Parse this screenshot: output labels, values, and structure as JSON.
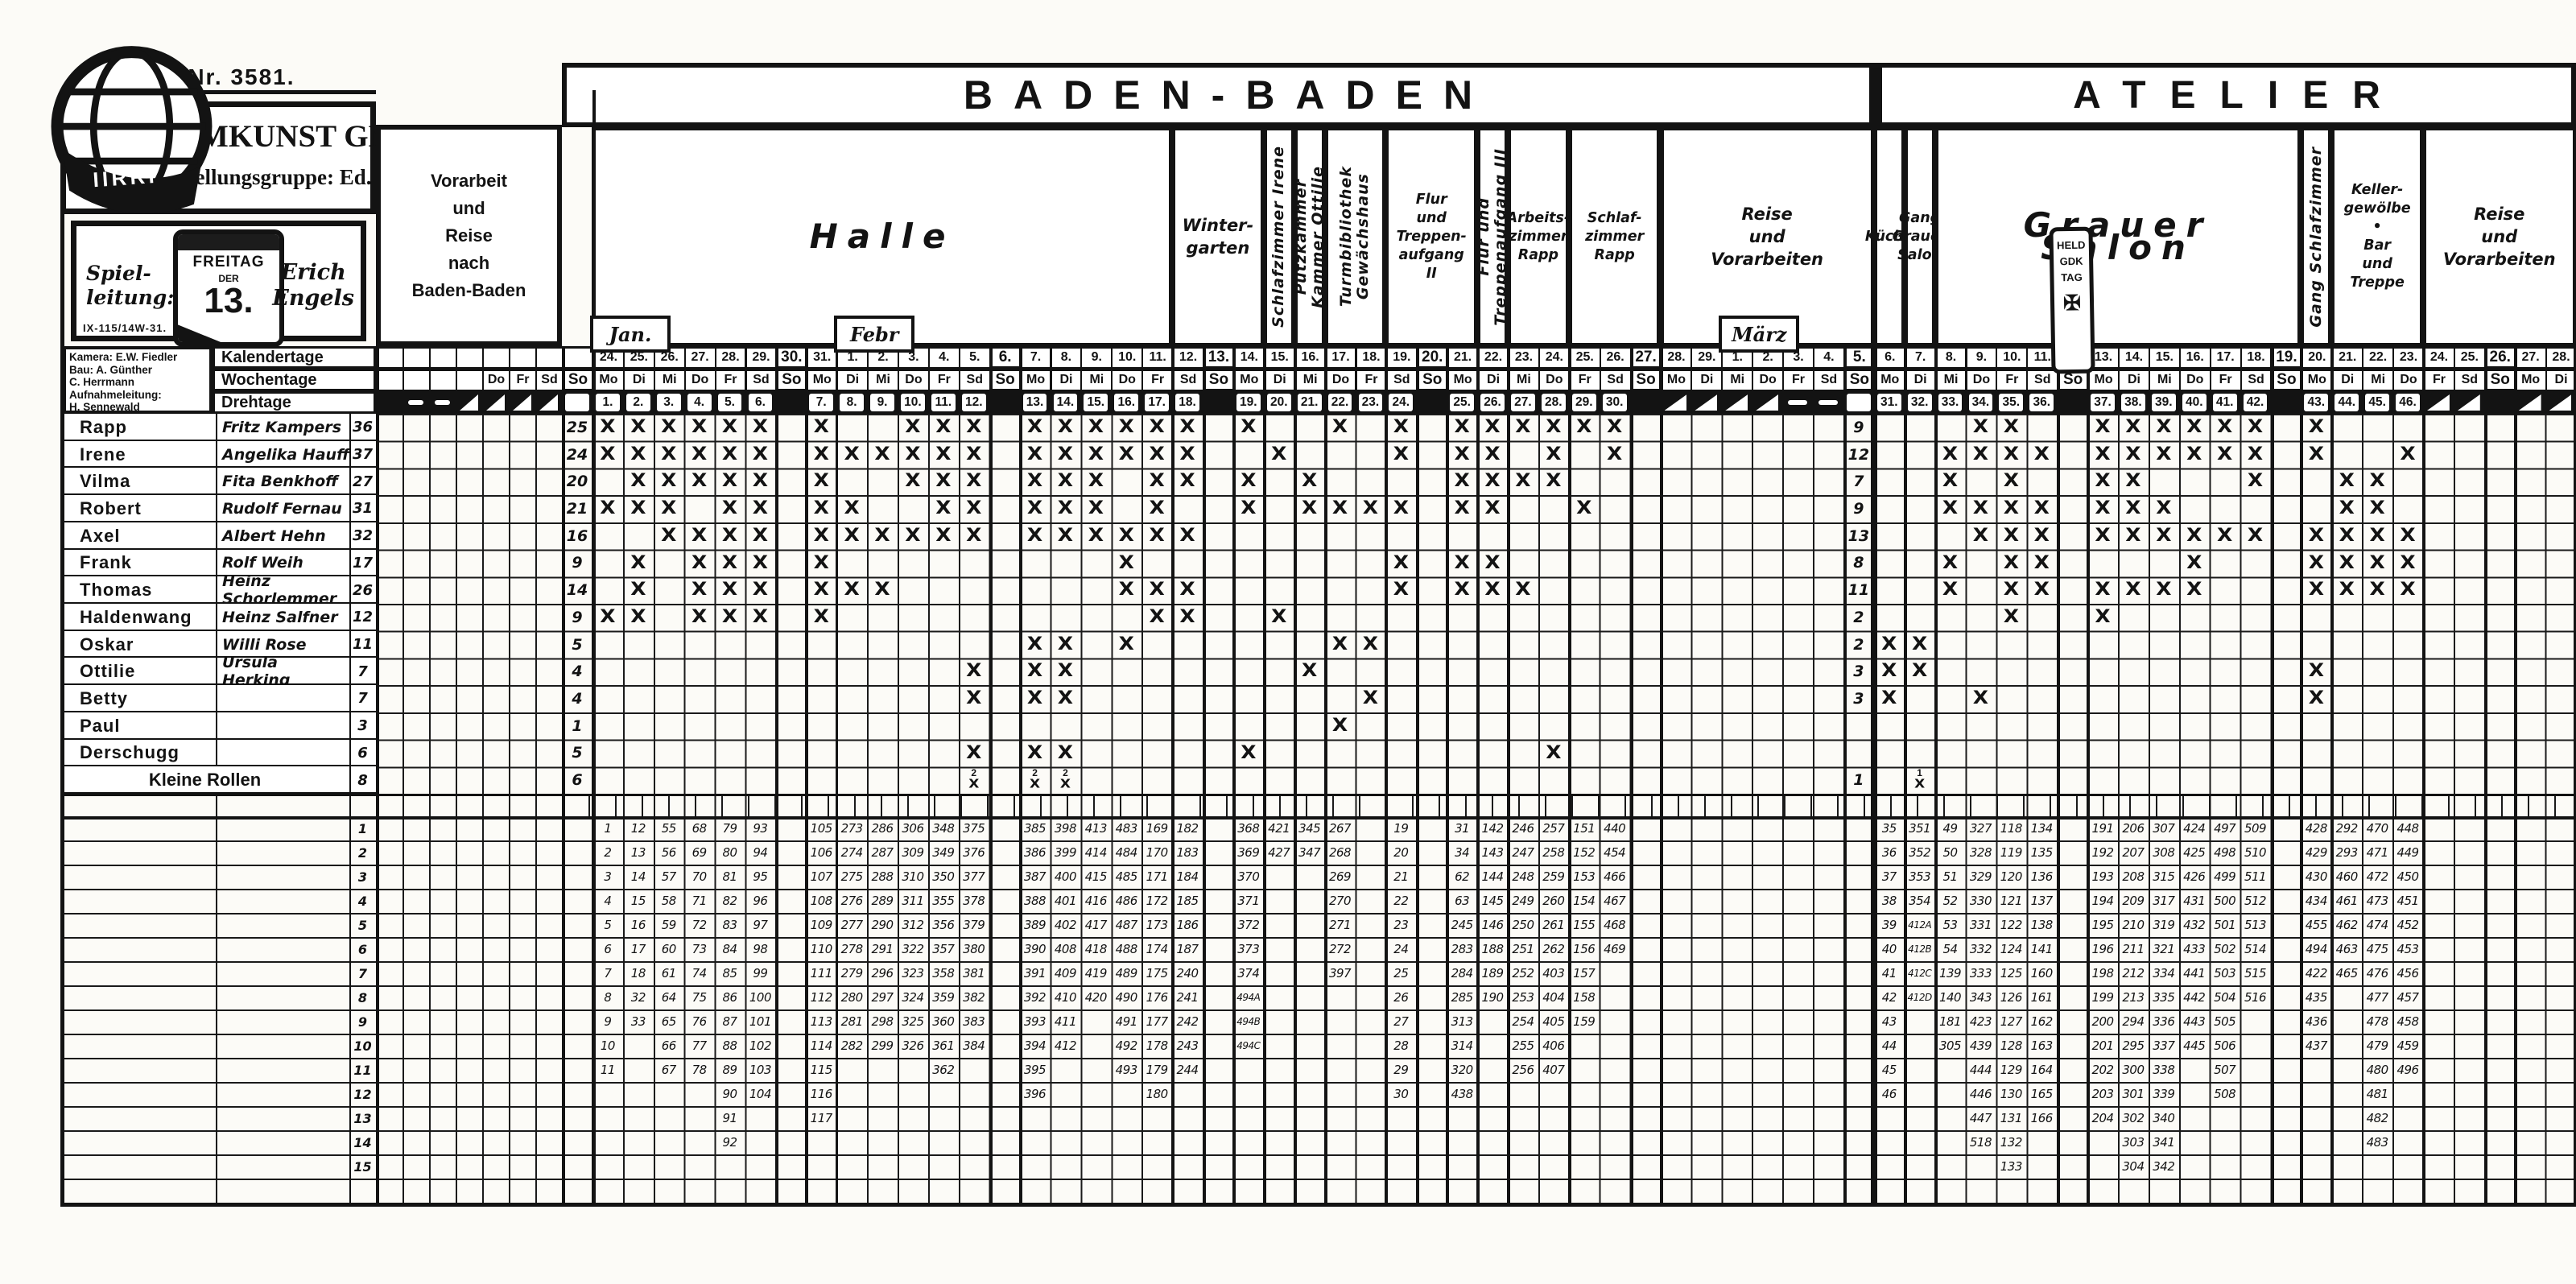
{
  "page": {
    "film_nr": "Film Nr. 3581.",
    "company": "FILMKUNST GMBH.",
    "company_group": "Herstellungsgruppe: Ed. Kubat",
    "spielleitung": [
      "Spiel-",
      "leitung:"
    ],
    "director": [
      "Erich",
      "Engels"
    ],
    "prod_code": "IX-115/14W-31.",
    "stamp": [
      "FREITAG",
      "DER",
      "13."
    ],
    "crew": [
      "Kamera: E.W. Fiedler",
      "Bau: A. Günther",
      "    C. Herrmann",
      "Aufnahmeleitung:",
      "    H. Sennewald"
    ],
    "logo_icon": "terra-globe-logo"
  },
  "sections": {
    "baden": "BADEN-BADEN",
    "atelier": "ATELIER",
    "vorarbeit": [
      "Vorarbeit",
      "und",
      "Reise",
      "nach",
      "Baden-Baden"
    ]
  },
  "row_labels": [
    "Kalendertage",
    "Wochentage",
    "Drehtage"
  ],
  "month_tabs": [
    {
      "label": "Jan.",
      "col": 0
    },
    {
      "label": "Febr",
      "col": 8
    },
    {
      "label": "März",
      "col": 37
    }
  ],
  "held_stamp": {
    "lines": [
      "HELD",
      "GDK",
      "TAG"
    ],
    "cross": "✠",
    "col": 48
  },
  "prep": {
    "wd": [
      "",
      "",
      "",
      "",
      "Do",
      "Fr",
      "Sd"
    ],
    "dt": [
      "bk",
      "d",
      "d",
      "h",
      "h",
      "h",
      "h"
    ]
  },
  "so_col": {
    "wd": "So"
  },
  "groups": {
    "baden": [
      {
        "l": [
          "Halle"
        ],
        "c": [
          0,
          18
        ],
        "big": 1
      },
      {
        "l": [
          "Winter-",
          "garten"
        ],
        "c": [
          19,
          21
        ]
      },
      {
        "l": [
          "Schlafzimmer Irene"
        ],
        "c": [
          22,
          22
        ],
        "vert": 1
      },
      {
        "l": [
          "Putzkammer",
          "Kammer Ottilie"
        ],
        "c": [
          23,
          23
        ],
        "vert": 1
      },
      {
        "l": [
          "Turmbibliothek",
          "Gewächshaus"
        ],
        "c": [
          24,
          25
        ],
        "vert": 1
      },
      {
        "l": [
          "Flur",
          "und",
          "Treppen-",
          "aufgang",
          "II"
        ],
        "c": [
          26,
          28
        ],
        "small": 1
      },
      {
        "l": [
          "Flur und",
          "Treppenaufgang III"
        ],
        "c": [
          29,
          29
        ],
        "vert": 1
      },
      {
        "l": [
          "Arbeits-",
          "zimmer",
          "Rapp"
        ],
        "c": [
          30,
          31
        ],
        "small": 1
      },
      {
        "l": [
          "Schlaf-",
          "zimmer",
          "Rapp"
        ],
        "c": [
          32,
          34
        ],
        "small": 1
      },
      {
        "l": [
          "Reise",
          "und",
          "Vorarbeiten"
        ],
        "c": [
          35,
          41
        ]
      }
    ],
    "atelier": [
      {
        "l": [
          "Küche"
        ],
        "c": [
          42,
          42
        ],
        "small": 1
      },
      {
        "l": [
          "Gang",
          "Grauer",
          "Salon"
        ],
        "c": [
          43,
          43
        ],
        "small": 1
      },
      {
        "l": [
          "Grauer Salon"
        ],
        "c": [
          44,
          55
        ],
        "big": 1
      },
      {
        "l": [
          "Gang Schlafzimmer"
        ],
        "c": [
          56,
          56
        ],
        "vert": 1
      },
      {
        "l": [
          "Keller-",
          "gewölbe",
          "•",
          "Bar",
          "und",
          "Treppe"
        ],
        "c": [
          57,
          59
        ],
        "small": 1
      },
      {
        "l": [
          "Reise",
          "und",
          "Vorarbeiten"
        ],
        "c": [
          60,
          64
        ]
      }
    ]
  },
  "columns": [
    [
      "24.",
      "Mo",
      "1",
      ""
    ],
    [
      "25.",
      "Di",
      "2",
      ""
    ],
    [
      "26.",
      "Mi",
      "3",
      ""
    ],
    [
      "27.",
      "Do",
      "4",
      ""
    ],
    [
      "28.",
      "Fr",
      "5",
      ""
    ],
    [
      "29.",
      "Sd",
      "6",
      ""
    ],
    [
      "30.",
      "So",
      "",
      "su"
    ],
    [
      "31.",
      "Mo",
      "7",
      ""
    ],
    [
      "1.",
      "Di",
      "8",
      ""
    ],
    [
      "2.",
      "Mi",
      "9",
      ""
    ],
    [
      "3.",
      "Do",
      "10",
      ""
    ],
    [
      "4.",
      "Fr",
      "11",
      ""
    ],
    [
      "5.",
      "Sd",
      "12",
      ""
    ],
    [
      "6.",
      "So",
      "",
      "su"
    ],
    [
      "7.",
      "Mo",
      "13",
      ""
    ],
    [
      "8.",
      "Di",
      "14",
      ""
    ],
    [
      "9.",
      "Mi",
      "15",
      ""
    ],
    [
      "10.",
      "Do",
      "16",
      ""
    ],
    [
      "11.",
      "Fr",
      "17",
      ""
    ],
    [
      "12.",
      "Sd",
      "18",
      ""
    ],
    [
      "13.",
      "So",
      "",
      "su"
    ],
    [
      "14.",
      "Mo",
      "19",
      ""
    ],
    [
      "15.",
      "Di",
      "20",
      ""
    ],
    [
      "16.",
      "Mi",
      "21",
      ""
    ],
    [
      "17.",
      "Do",
      "22",
      ""
    ],
    [
      "18.",
      "Fr",
      "23",
      ""
    ],
    [
      "19.",
      "Sd",
      "24",
      ""
    ],
    [
      "20.",
      "So",
      "",
      "su"
    ],
    [
      "21.",
      "Mo",
      "25",
      ""
    ],
    [
      "22.",
      "Di",
      "26",
      ""
    ],
    [
      "23.",
      "Mi",
      "27",
      ""
    ],
    [
      "24.",
      "Do",
      "28",
      ""
    ],
    [
      "25.",
      "Fr",
      "29",
      ""
    ],
    [
      "26.",
      "Sd",
      "30",
      ""
    ],
    [
      "27.",
      "So",
      "",
      "su"
    ],
    [
      "28.",
      "Mo",
      "",
      "h"
    ],
    [
      "29.",
      "Di",
      "",
      "h"
    ],
    [
      "1.",
      "Mi",
      "",
      "h"
    ],
    [
      "2.",
      "Do",
      "",
      "h"
    ],
    [
      "3.",
      "Fr",
      "",
      "d"
    ],
    [
      "4.",
      "Sd",
      "",
      "d"
    ],
    [
      "5.",
      "So",
      "",
      "ct"
    ],
    [
      "6.",
      "Mo",
      "31",
      ""
    ],
    [
      "7.",
      "Di",
      "32",
      ""
    ],
    [
      "8.",
      "Mi",
      "33",
      ""
    ],
    [
      "9.",
      "Do",
      "34",
      ""
    ],
    [
      "10.",
      "Fr",
      "35",
      ""
    ],
    [
      "11.",
      "Sd",
      "36",
      ""
    ],
    [
      "12.",
      "So",
      "",
      "bk"
    ],
    [
      "13.",
      "Mo",
      "37",
      ""
    ],
    [
      "14.",
      "Di",
      "38",
      ""
    ],
    [
      "15.",
      "Mi",
      "39",
      ""
    ],
    [
      "16.",
      "Do",
      "40",
      ""
    ],
    [
      "17.",
      "Fr",
      "41",
      ""
    ],
    [
      "18.",
      "Sd",
      "42",
      ""
    ],
    [
      "19.",
      "So",
      "",
      "su"
    ],
    [
      "20.",
      "Mo",
      "43",
      ""
    ],
    [
      "21.",
      "Di",
      "44",
      ""
    ],
    [
      "22.",
      "Mi",
      "45",
      ""
    ],
    [
      "23.",
      "Do",
      "46",
      ""
    ],
    [
      "24.",
      "Fr",
      "",
      "h"
    ],
    [
      "25.",
      "Sd",
      "",
      "h"
    ],
    [
      "26.",
      "So",
      "",
      "su"
    ],
    [
      "27.",
      "Mo",
      "",
      "h"
    ],
    [
      "28.",
      "Di",
      "",
      "h"
    ]
  ],
  "cast": [
    {
      "role": "Rapp",
      "actor": "Fritz Kampers",
      "total": "36",
      "bb": "25",
      "at": "9",
      "x": [
        1,
        2,
        3,
        4,
        5,
        6,
        7,
        10,
        11,
        12,
        13,
        14,
        15,
        16,
        17,
        18,
        19,
        22,
        24,
        25,
        26,
        27,
        28,
        29,
        30,
        34,
        35,
        37,
        38,
        39,
        40,
        41,
        42,
        43
      ]
    },
    {
      "role": "Irene",
      "actor": "Angelika Hauff",
      "total": "37",
      "bb": "24",
      "at": "12",
      "x": [
        1,
        2,
        3,
        4,
        5,
        6,
        7,
        8,
        9,
        10,
        11,
        12,
        13,
        14,
        15,
        16,
        17,
        18,
        20,
        24,
        25,
        26,
        28,
        30,
        33,
        34,
        35,
        36,
        37,
        38,
        39,
        40,
        41,
        42,
        43,
        46
      ]
    },
    {
      "role": "Vilma",
      "actor": "Fita Benkhoff",
      "total": "27",
      "bb": "20",
      "at": "7",
      "x": [
        2,
        3,
        4,
        5,
        6,
        7,
        10,
        11,
        12,
        13,
        14,
        15,
        17,
        18,
        19,
        21,
        25,
        26,
        27,
        28,
        33,
        35,
        37,
        38,
        42,
        44,
        45
      ]
    },
    {
      "role": "Robert",
      "actor": "Rudolf Fernau",
      "total": "31",
      "bb": "21",
      "at": "9",
      "x": [
        1,
        2,
        3,
        5,
        6,
        7,
        8,
        11,
        12,
        13,
        14,
        15,
        17,
        19,
        21,
        22,
        23,
        24,
        25,
        26,
        29,
        33,
        34,
        35,
        36,
        37,
        38,
        39,
        44,
        45
      ]
    },
    {
      "role": "Axel",
      "actor": "Albert Hehn",
      "total": "32",
      "bb": "16",
      "at": "13",
      "x": [
        3,
        4,
        5,
        6,
        7,
        8,
        9,
        10,
        11,
        12,
        13,
        14,
        15,
        16,
        17,
        18,
        34,
        35,
        36,
        37,
        38,
        39,
        40,
        41,
        42,
        43,
        44,
        45,
        46
      ]
    },
    {
      "role": "Frank",
      "actor": "Rolf Weih",
      "total": "17",
      "bb": "9",
      "at": "8",
      "x": [
        2,
        4,
        5,
        6,
        7,
        16,
        24,
        25,
        26,
        33,
        35,
        36,
        40,
        43,
        44,
        45,
        46
      ]
    },
    {
      "role": "Thomas",
      "actor": "Heinz Schorlemmer",
      "total": "26",
      "bb": "14",
      "at": "11",
      "x": [
        2,
        4,
        5,
        6,
        7,
        8,
        9,
        16,
        17,
        18,
        24,
        25,
        26,
        27,
        33,
        35,
        36,
        37,
        38,
        39,
        40,
        43,
        44,
        45,
        46
      ]
    },
    {
      "role": "Haldenwang",
      "actor": "Heinz Salfner",
      "total": "12",
      "bb": "9",
      "at": "2",
      "x": [
        1,
        2,
        4,
        5,
        6,
        7,
        17,
        18,
        20,
        35,
        37
      ]
    },
    {
      "role": "Oskar",
      "actor": "Willi Rose",
      "total": "11",
      "bb": "5",
      "at": "2",
      "x": [
        13,
        14,
        16,
        22,
        23,
        31,
        32
      ]
    },
    {
      "role": "Ottilie",
      "actor": "Ursula Herking",
      "total": "7",
      "bb": "4",
      "at": "3",
      "x": [
        12,
        13,
        14,
        21,
        31,
        32,
        43
      ]
    },
    {
      "role": "Betty",
      "actor": "",
      "total": "7",
      "bb": "4",
      "at": "3",
      "x": [
        12,
        13,
        14,
        23,
        31,
        34,
        43
      ]
    },
    {
      "role": "Paul",
      "actor": "",
      "total": "3",
      "bb": "1",
      "at": "",
      "x": [
        22
      ]
    },
    {
      "role": "Derschugg",
      "actor": "",
      "total": "6",
      "bb": "5",
      "at": "",
      "x": [
        12,
        13,
        14,
        19,
        28
      ]
    },
    {
      "role": "Kleine Rollen",
      "actor": "",
      "total": "8",
      "bb": "6",
      "at": "1",
      "span": 1,
      "x": [],
      "xn": [
        [
          12,
          "2"
        ],
        [
          13,
          "2"
        ],
        [
          14,
          "2"
        ],
        [
          32,
          "1"
        ]
      ]
    }
  ],
  "bottom_rows": [
    "1",
    "2",
    "3",
    "4",
    "5",
    "6",
    "7",
    "8",
    "9",
    "10",
    "11",
    "12",
    "13",
    "14",
    "15",
    ""
  ],
  "scenes": {
    "1": [
      "1",
      "2",
      "3",
      "4",
      "5",
      "6",
      "7",
      "8",
      "9",
      "10",
      "11"
    ],
    "2": [
      "12",
      "13",
      "14",
      "15",
      "16",
      "17",
      "18",
      "32",
      "33"
    ],
    "3": [
      "55",
      "56",
      "57",
      "58",
      "59",
      "60",
      "61",
      "64",
      "65",
      "66",
      "67"
    ],
    "4": [
      "68",
      "69",
      "70",
      "71",
      "72",
      "73",
      "74",
      "75",
      "76",
      "77",
      "78"
    ],
    "5": [
      "79",
      "80",
      "81",
      "82",
      "83",
      "84",
      "85",
      "86",
      "87",
      "88",
      "89",
      "90",
      "91",
      "92"
    ],
    "6": [
      "93",
      "94",
      "95",
      "96",
      "97",
      "98",
      "99",
      "100",
      "101",
      "102",
      "103",
      "104"
    ],
    "7": [
      "105",
      "106",
      "107",
      "108",
      "109",
      "110",
      "111",
      "112",
      "113",
      "114",
      "115",
      "116",
      "117"
    ],
    "8": [
      "273",
      "274",
      "275",
      "276",
      "277",
      "278",
      "279",
      "280",
      "281",
      "282"
    ],
    "9": [
      "286",
      "287",
      "288",
      "289",
      "290",
      "291",
      "296",
      "297",
      "298",
      "299"
    ],
    "10": [
      "306",
      "309",
      "310",
      "311",
      "312",
      "322",
      "323",
      "324",
      "325",
      "326"
    ],
    "11": [
      "348",
      "349",
      "350",
      "355",
      "356",
      "357",
      "358",
      "359",
      "360",
      "361",
      "362"
    ],
    "12": [
      "375",
      "376",
      "377",
      "378",
      "379",
      "380",
      "381",
      "382",
      "383",
      "384"
    ],
    "13": [
      "385",
      "386",
      "387",
      "388",
      "389",
      "390",
      "391",
      "392",
      "393",
      "394",
      "395",
      "396"
    ],
    "14": [
      "398",
      "399",
      "400",
      "401",
      "402",
      "408",
      "409",
      "410",
      "411",
      "412"
    ],
    "15": [
      "413",
      "414",
      "415",
      "416",
      "417",
      "418",
      "419",
      "420"
    ],
    "16": [
      "483",
      "484",
      "485",
      "486",
      "487",
      "488",
      "489",
      "490",
      "491",
      "492",
      "493"
    ],
    "17": [
      "169",
      "170",
      "171",
      "172",
      "173",
      "174",
      "175",
      "176",
      "177",
      "178",
      "179",
      "180"
    ],
    "18": [
      "182",
      "183",
      "184",
      "185",
      "186",
      "187",
      "240",
      "241",
      "242",
      "243",
      "244"
    ],
    "19": [
      "368",
      "369",
      "370",
      "371",
      "372",
      "373",
      "374",
      "494A",
      "494B",
      "494C"
    ],
    "20": [
      "421",
      "427"
    ],
    "21": [
      "345",
      "347"
    ],
    "22": [
      "267",
      "268",
      "269",
      "270",
      "271",
      "272",
      "397"
    ],
    "24": [
      "19",
      "20",
      "21",
      "22",
      "23",
      "24",
      "25",
      "26",
      "27",
      "28",
      "29",
      "30"
    ],
    "25": [
      "31",
      "34",
      "62",
      "63",
      "245",
      "283",
      "284",
      "285",
      "313",
      "314",
      "320",
      "438"
    ],
    "26": [
      "142",
      "143",
      "144",
      "145",
      "146",
      "188",
      "189",
      "190"
    ],
    "27": [
      "246",
      "247",
      "248",
      "249",
      "250",
      "251",
      "252",
      "253",
      "254",
      "255",
      "256"
    ],
    "28": [
      "257",
      "258",
      "259",
      "260",
      "261",
      "262",
      "403",
      "404",
      "405",
      "406",
      "407"
    ],
    "29": [
      "151",
      "152",
      "153",
      "154",
      "155",
      "156",
      "157",
      "158",
      "159"
    ],
    "30": [
      "440",
      "454",
      "466",
      "467",
      "468",
      "469"
    ],
    "31": [
      "35",
      "36",
      "37",
      "38",
      "39",
      "40",
      "41",
      "42",
      "43",
      "44",
      "45",
      "46"
    ],
    "32": [
      "351",
      "352",
      "353",
      "354",
      "412A",
      "412B",
      "412C",
      "412D"
    ],
    "33": [
      "49",
      "50",
      "51",
      "52",
      "53",
      "54",
      "139",
      "140",
      "181",
      "305"
    ],
    "34": [
      "327",
      "328",
      "329",
      "330",
      "331",
      "332",
      "333",
      "343",
      "423",
      "439",
      "444",
      "446",
      "447",
      "518"
    ],
    "35": [
      "118",
      "119",
      "120",
      "121",
      "122",
      "124",
      "125",
      "126",
      "127",
      "128",
      "129",
      "130",
      "131",
      "132",
      "133"
    ],
    "36": [
      "134",
      "135",
      "136",
      "137",
      "138",
      "141",
      "160",
      "161",
      "162",
      "163",
      "164",
      "165",
      "166"
    ],
    "37": [
      "191",
      "192",
      "193",
      "194",
      "195",
      "196",
      "198",
      "199",
      "200",
      "201",
      "202",
      "203",
      "204"
    ],
    "38": [
      "206",
      "207",
      "208",
      "209",
      "210",
      "211",
      "212",
      "213",
      "294",
      "295",
      "300",
      "301",
      "302",
      "303",
      "304"
    ],
    "39": [
      "307",
      "308",
      "315",
      "317",
      "319",
      "321",
      "334",
      "335",
      "336",
      "337",
      "338",
      "339",
      "340",
      "341",
      "342"
    ],
    "40": [
      "424",
      "425",
      "426",
      "431",
      "432",
      "433",
      "441",
      "442",
      "443",
      "445"
    ],
    "41": [
      "497",
      "498",
      "499",
      "500",
      "501",
      "502",
      "503",
      "504",
      "505",
      "506",
      "507",
      "508"
    ],
    "42": [
      "509",
      "510",
      "511",
      "512",
      "513",
      "514",
      "515",
      "516"
    ],
    "43": [
      "428",
      "429",
      "430",
      "434",
      "455",
      "494",
      "422",
      "435",
      "436",
      "437"
    ],
    "44": [
      "292",
      "293",
      "460",
      "461",
      "462",
      "463",
      "465"
    ],
    "45": [
      "470",
      "471",
      "472",
      "473",
      "474",
      "475",
      "476",
      "477",
      "478",
      "479",
      "480",
      "481",
      "482",
      "483"
    ],
    "46": [
      "448",
      "449",
      "450",
      "451",
      "452",
      "453",
      "456",
      "457",
      "458",
      "459",
      "496"
    ]
  }
}
